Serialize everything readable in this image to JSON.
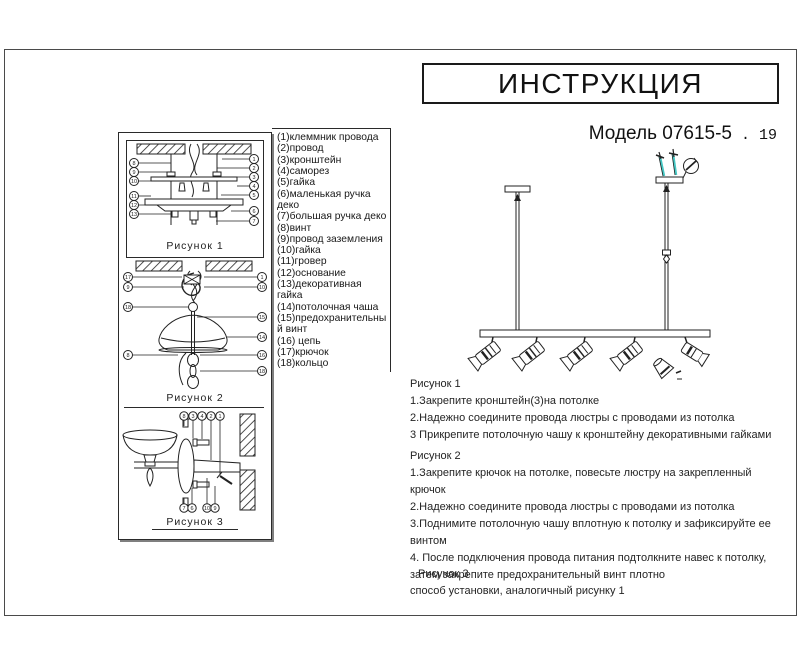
{
  "page": {
    "title": "ИНСТРУКЦИЯ",
    "model_main": "Модель 07615-5",
    "model_suffix": " . 19"
  },
  "colors": {
    "line": "#222222",
    "accent_teal": "#45c8c4"
  },
  "parts": [
    "(1)клеммник провода",
    "(2)провод",
    "(3)кронштейн",
    "(4)саморез",
    "(5)гайка",
    "(6)маленькая ручка деко",
    "(7)большая ручка деко",
    "(8)винт",
    "(9)провод заземления",
    "(10)гайка",
    "(11)гровер",
    "(12)основание",
    "(13)декоративная гайка",
    "(14)потолочная чаша",
    "(15)предохранительный винт",
    "(16) цепь",
    "(17)крючок",
    "(18)кольцо"
  ],
  "figures": {
    "fig1": {
      "label": "Рисунок 1",
      "left": [
        "8",
        "9",
        "10",
        "11",
        "12",
        "13"
      ],
      "right": [
        "1",
        "2",
        "3",
        "4",
        "5",
        "6",
        "7"
      ]
    },
    "fig2": {
      "label": "Рисунок 2",
      "left": [
        "17",
        "9",
        "18",
        "8"
      ],
      "right": [
        "1",
        "10",
        "15",
        "14",
        "16",
        "18"
      ]
    },
    "fig3": {
      "label": "Рисунок 3",
      "top": [
        "8",
        "3",
        "4",
        "2",
        "1"
      ],
      "bottom": [
        "7",
        "6",
        "10",
        "9"
      ]
    }
  },
  "instructions": {
    "fig1": {
      "heading": "Рисунок 1",
      "lines": [
        "1.Закрепите кронштейн(3)на потолке",
        "2.Надежно соедините провода люстры с проводами из потолка",
        "3 Прикрепите потолочную чашу к кронштейну декоративными гайками"
      ]
    },
    "fig2": {
      "heading": "Рисунок 2",
      "lines": [
        "1.Закрепите крючок на потолке, повесьте люстру на закрепленный крючок",
        "2.Надежно соедините провода люстры с проводами из потолка",
        "3.Поднимите потолочную чашу вплотную к потолку и зафиксируйте ее винтом",
        "4.  После подключения провода питания подтолкните навес к потолку, затем закрепите предохранительный винт плотно"
      ]
    },
    "fig3": {
      "heading": "Рисунок 3",
      "lines": [
        "способ установки, аналогичный рисунку 1"
      ]
    }
  }
}
